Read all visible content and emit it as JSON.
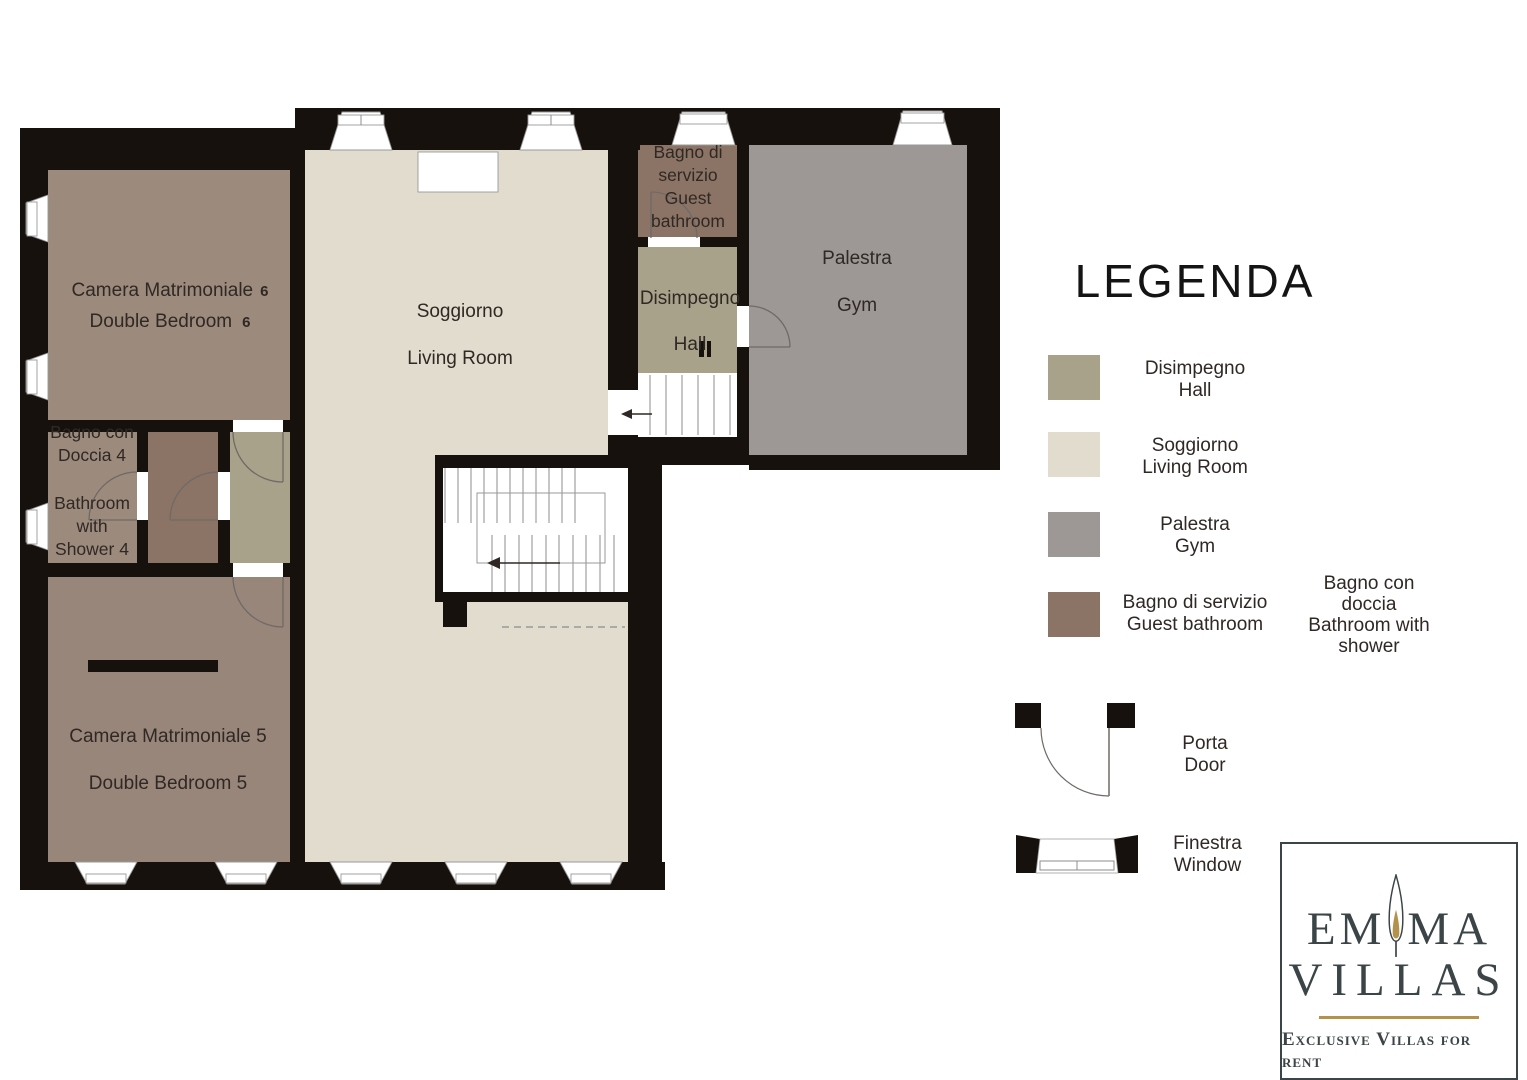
{
  "colors": {
    "wall": "#17110d",
    "living": "#e2dcce",
    "hall": "#a9a28a",
    "gym": "#9d9896",
    "guest_bathroom": "#8b7465",
    "bedroom": "#9c8b7c",
    "bedroom5": "#99867a",
    "label": "#2f2824",
    "logo_dark": "#3b4446",
    "gold": "#b3924c"
  },
  "rooms": {
    "bedroom6": {
      "it": "Camera Matrimoniale",
      "en": "Double Bedroom",
      "num": "6"
    },
    "bedroom5": {
      "it": "Camera Matrimoniale 5",
      "en": "Double Bedroom 5"
    },
    "living": {
      "it": "Soggiorno",
      "en": "Living Room"
    },
    "hall": {
      "it": "Disimpegno",
      "en": "Hall"
    },
    "gym": {
      "it": "Palestra",
      "en": "Gym"
    },
    "guest_bathroom": {
      "l1": "Bagno di",
      "l2": "servizio",
      "l3": "Guest",
      "l4": "bathroom"
    },
    "bathroom4": {
      "l1": "Bagno con",
      "l2": "Doccia 4",
      "l3": "Bathroom",
      "l4": "with",
      "l5": "Shower 4"
    }
  },
  "legend": {
    "title": "LEGENDA",
    "items": [
      {
        "key": "hall",
        "line1": "Disimpegno",
        "line2": "Hall"
      },
      {
        "key": "living",
        "line1": "Soggiorno",
        "line2": "Living Room"
      },
      {
        "key": "gym",
        "line1": "Palestra",
        "line2": "Gym"
      },
      {
        "key": "guest_bathroom",
        "line1": "Bagno di servizio",
        "line2": "Guest bathroom"
      }
    ],
    "shower_note": {
      "l1": "Bagno con",
      "l2": "doccia",
      "l3": "Bathroom with",
      "l4": "shower"
    },
    "door": {
      "line1": "Porta",
      "line2": "Door"
    },
    "window": {
      "line1": "Finestra",
      "line2": "Window"
    }
  },
  "logo": {
    "word1_left": "EM",
    "word1_right": "MA",
    "word2": "VILLAS",
    "tagline": "Exclusive Villas for rent"
  }
}
